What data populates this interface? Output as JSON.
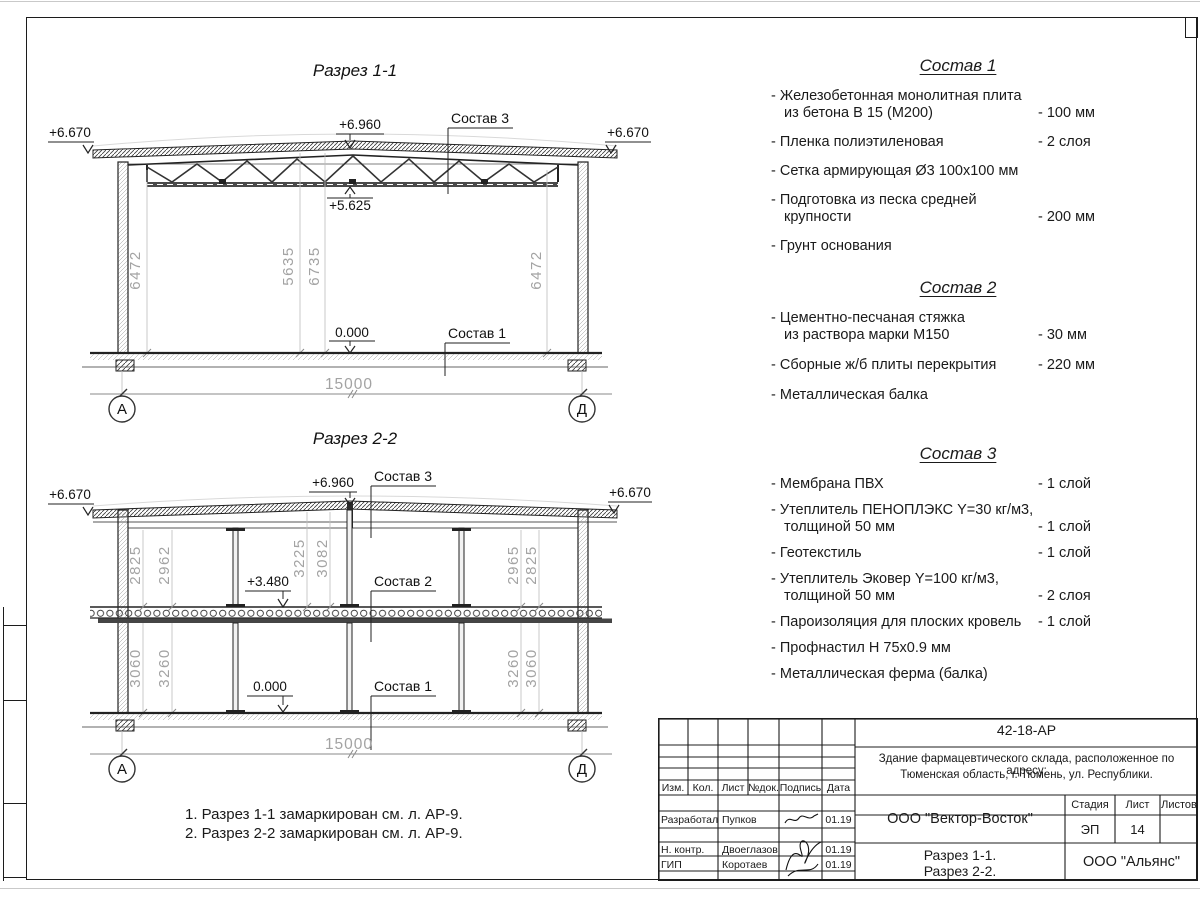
{
  "section1": {
    "title": "Разрез 1-1",
    "level_left": "+6.670",
    "level_right": "+6.670",
    "level_apex": "+6.960",
    "level_truss": "+5.625",
    "level_floor": "0.000",
    "callout_roof": "Состав 3",
    "callout_floor": "Состав 1",
    "dim_left": "6472",
    "dim_mid1": "5635",
    "dim_mid2": "6735",
    "dim_right": "6472",
    "dim_span": "15000",
    "axis_left": "А",
    "axis_right": "Д"
  },
  "section2": {
    "title": "Разрез 2-2",
    "level_left": "+6.670",
    "level_right": "+6.670",
    "level_apex": "+6.960",
    "level_mid": "+3.480",
    "level_floor": "0.000",
    "callout_roof": "Состав 3",
    "callout_mid": "Состав 2",
    "callout_floor": "Состав 1",
    "dim_u1": "2825",
    "dim_u2": "2962",
    "dim_u3": "3225",
    "dim_u4": "3082",
    "dim_u5": "2965",
    "dim_u6": "2825",
    "dim_l1": "3060",
    "dim_l2": "3260",
    "dim_l3": "3260",
    "dim_l4": "3060",
    "dim_span": "15000",
    "axis_left": "А",
    "axis_right": "Д"
  },
  "compositions": [
    {
      "title": "Состав 1",
      "items": [
        {
          "text": "- Железобетонная  монолитная плита\nиз бетона В 15 (М200)",
          "value": "- 100 мм"
        },
        {
          "text": "- Пленка полиэтиленовая",
          "value": "-  2 слоя"
        },
        {
          "text": "- Сетка армирующая Ø3 100х100 мм",
          "value": ""
        },
        {
          "text": "- Подготовка из песка средней\nкрупности",
          "value": "- 200 мм"
        },
        {
          "text": "- Грунт основания",
          "value": ""
        }
      ]
    },
    {
      "title": "Состав 2",
      "items": [
        {
          "text": "- Цементно-песчаная стяжка\nиз раствора марки М150",
          "value": "- 30 мм"
        },
        {
          "text": "- Сборные ж/б плиты перекрытия",
          "value": "- 220 мм"
        },
        {
          "text": "- Металлическая балка",
          "value": ""
        }
      ]
    },
    {
      "title": "Состав 3",
      "items": [
        {
          "text": "- Мембрана ПВХ",
          "value": "- 1 слой"
        },
        {
          "text": "- Утеплитель ПЕНОПЛЭКС Y=30 кг/м3,\nтолщиной 50 мм",
          "value": "- 1 слой"
        },
        {
          "text": "- Геотекстиль",
          "value": "- 1 слой"
        },
        {
          "text": "- Утеплитель Эковер Y=100 кг/м3,\nтолщиной 50 мм",
          "value": "- 2 слоя"
        },
        {
          "text": "- Пароизоляция для плоских кровель",
          "value": "- 1 слой"
        },
        {
          "text": "- Профнастил Н 75х0.9 мм",
          "value": ""
        },
        {
          "text": "- Металлическая ферма (балка)",
          "value": ""
        }
      ]
    }
  ],
  "notes": [
    "1. Разрез 1-1 замаркирован см. л. АР-9.",
    "2. Разрез 2-2 замаркирован см. л. АР-9."
  ],
  "titleblock": {
    "doc_number": "42-18-АР",
    "project_line1": "Здание фармацевтического склада, расположенное по адресу:",
    "project_line2": "Тюменская область, г. Тюмень, ул. Республики.",
    "col_izm": "Изм.",
    "col_kol": "Кол.",
    "col_list": "Лист",
    "col_ndok": "№док.",
    "col_podpis": "Подпись",
    "col_data": "Дата",
    "rows": [
      {
        "role": "Разработал",
        "name": "Пупков",
        "date": "01.19"
      },
      {
        "role": "Н. контр.",
        "name": "Двоеглазов",
        "date": "01.19"
      },
      {
        "role": "ГИП",
        "name": "Коротаев",
        "date": "01.19"
      }
    ],
    "developer": "ООО \"Вектор-Восток\"",
    "stage_label": "Стадия",
    "sheet_label": "Лист",
    "sheets_label": "Листов",
    "stage": "ЭП",
    "sheet": "14",
    "sheets": "",
    "sheet_title1": "Разрез 1-1.",
    "sheet_title2": "Разрез 2-2.",
    "firm": "ООО \"Альянс\""
  }
}
